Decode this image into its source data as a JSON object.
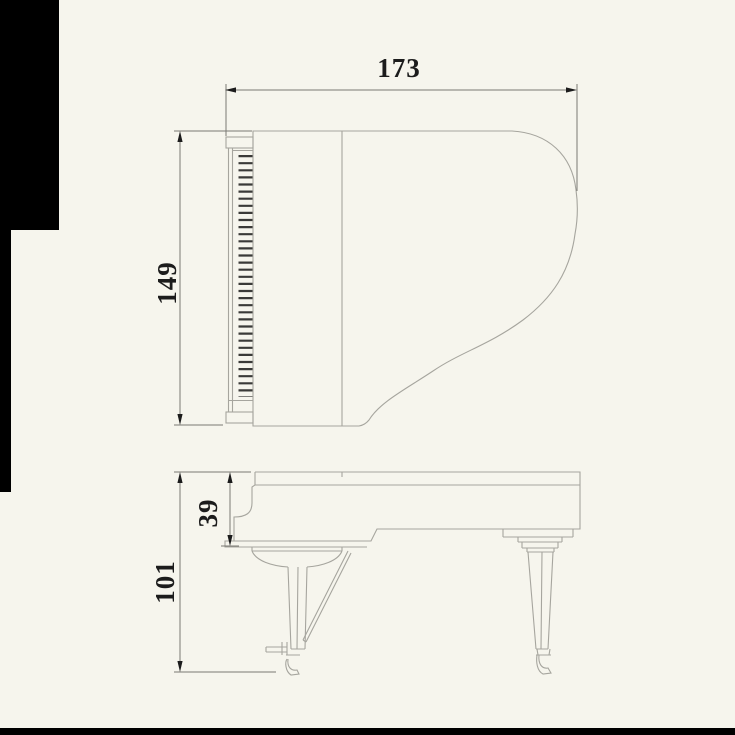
{
  "diagram": {
    "subject": "grand-piano-dimension-drawing",
    "views": [
      {
        "id": "top-view",
        "description": "plan view of grand piano, keyboard at left"
      },
      {
        "id": "side-view",
        "description": "side elevation of grand piano with legs, pedal lyre and casters"
      }
    ],
    "dimensions": [
      {
        "id": "length",
        "value": "173",
        "view": "top-view",
        "orientation": "horizontal"
      },
      {
        "id": "width",
        "value": "149",
        "view": "top-view",
        "orientation": "vertical"
      },
      {
        "id": "case-height",
        "value": "39",
        "view": "side-view",
        "orientation": "vertical"
      },
      {
        "id": "total-height",
        "value": "101",
        "view": "side-view",
        "orientation": "vertical"
      }
    ],
    "colors": {
      "background": "#f6f5ed",
      "outline": "#a6a59e",
      "dimension_line": "#7a7973",
      "text": "#1c1c1c",
      "edge_mask": "#000000"
    }
  }
}
